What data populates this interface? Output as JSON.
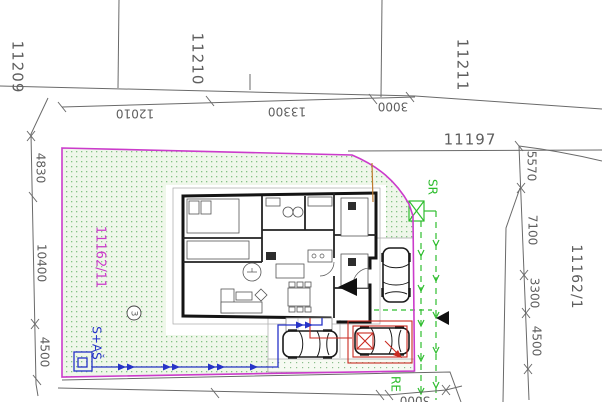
{
  "title": "Cadastral site plan with house floor plan",
  "drawing": {
    "parcels": {
      "road_top_left": "11209",
      "road_top_mid": "11210",
      "road_top_right": "11211",
      "road_right": "11197",
      "neighbor_right": "11162/1",
      "site_parcel": "11162/11"
    },
    "dimensions": {
      "top": [
        "12010",
        "13300",
        "3000"
      ],
      "left": [
        "4830",
        "10400",
        "4500"
      ],
      "right": [
        "5570",
        "7100",
        "3300",
        "4500"
      ],
      "bottom": [
        "3000"
      ]
    },
    "annotations": {
      "sr_line": "SR",
      "re_line": "RE",
      "utility_connection": "S+AŠ",
      "point_number": "3"
    },
    "colors": {
      "boundary_magenta": "#cb3bcb",
      "utility_green": "#2ebd2e",
      "utility_blue": "#2633c8",
      "carport_red": "#c92a21",
      "lawn_fill": "#eff7ea",
      "lawn_dot": "#85c285",
      "line_gray": "#6a6a6a"
    }
  }
}
